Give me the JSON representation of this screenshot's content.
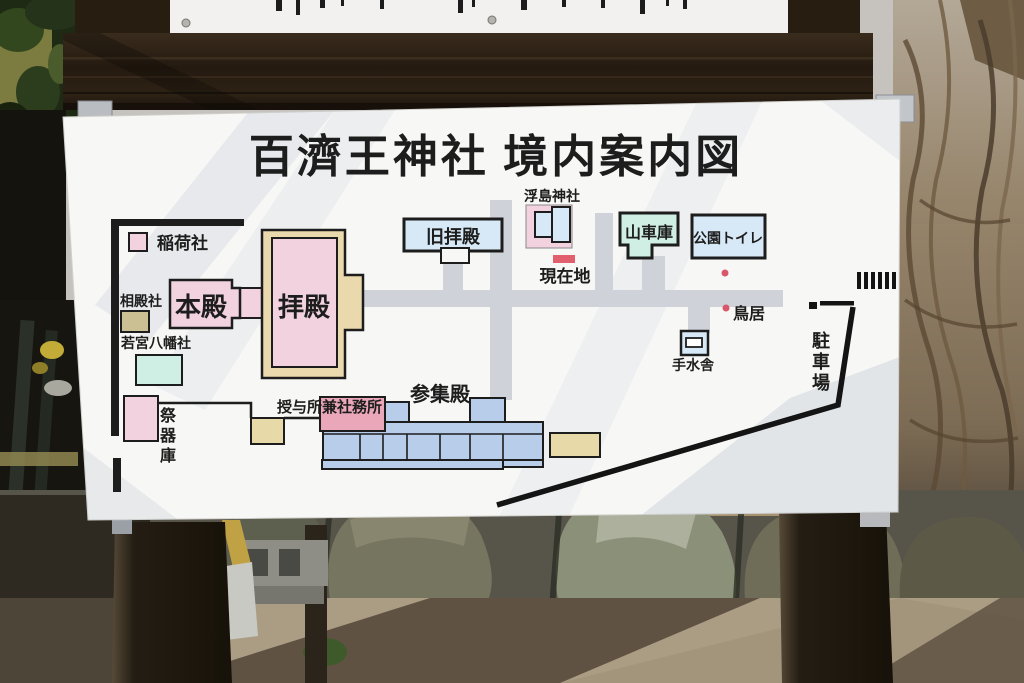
{
  "sign": {
    "title": "百濟王神社 境内案内図",
    "labels": {
      "inari": "稲荷社",
      "aidono": "相殿社",
      "wakamiya_hachiman": "若宮八幡社",
      "honden": "本殿",
      "haiden": "拝殿",
      "kyu_haiden": "旧拝殿",
      "ukishima_jinja": "浮島神社",
      "genzaichi": "現在地",
      "dashi_gura": "山車庫",
      "koen_toilet": "公園トイレ",
      "torii": "鳥居",
      "temizusha": "手水舎",
      "chushajo": "駐車場",
      "saikigura": "祭器庫",
      "sanshuden": "参集殿",
      "juyosho_shamusho": "授与所兼社務所"
    },
    "colors": {
      "shrine_pink": "#f1d2de",
      "office_pink": "#eba7ba",
      "marker_red": "#e25f6e",
      "dot_red": "#d9576a",
      "cream": "#e9d9ac",
      "tan": "#e8d9a9",
      "khaki": "#cbc094",
      "cyan": "#cfeee4",
      "light_blue": "#d7e9f6",
      "building_blue": "#b7cdea",
      "path_gray": "#cfd2d8",
      "line_black": "#1d1d1d",
      "sign_white": "#f7f7f5"
    }
  }
}
